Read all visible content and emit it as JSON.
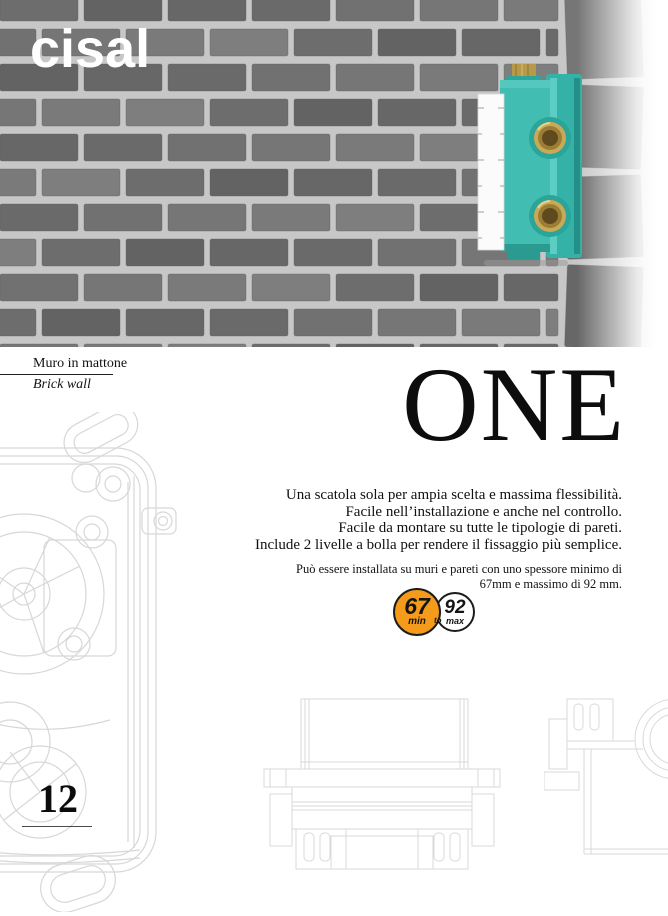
{
  "brand": {
    "logo": "cisal"
  },
  "photo": {
    "caption_it": "Muro in mattone",
    "caption_en": "Brick wall"
  },
  "product": {
    "name": "ONE",
    "description_lines": [
      "Una scatola sola per ampia scelta e massima flessibilità.",
      "Facile nell’installazione e anche nel controllo.",
      "Facile da montare su tutte le tipologie di pareti.",
      "Include 2 livelle a bolla per rendere il fissaggio più semplice."
    ],
    "note_lines": [
      "Può essere installata su muri e pareti con uno spessore minimo di",
      "67mm e massimo di 92 mm."
    ]
  },
  "badge": {
    "min_value": "67",
    "min_label": "min",
    "connector": "to",
    "max_value": "92",
    "max_label": "max",
    "min_color": "#f59b1b",
    "max_color": "#ffffff"
  },
  "page_number": "12",
  "colors": {
    "product_teal": "#41bdb2",
    "brass": "#bfa14e",
    "accent_orange": "#f59b1b",
    "drawing_line": "#d7d7d7"
  }
}
